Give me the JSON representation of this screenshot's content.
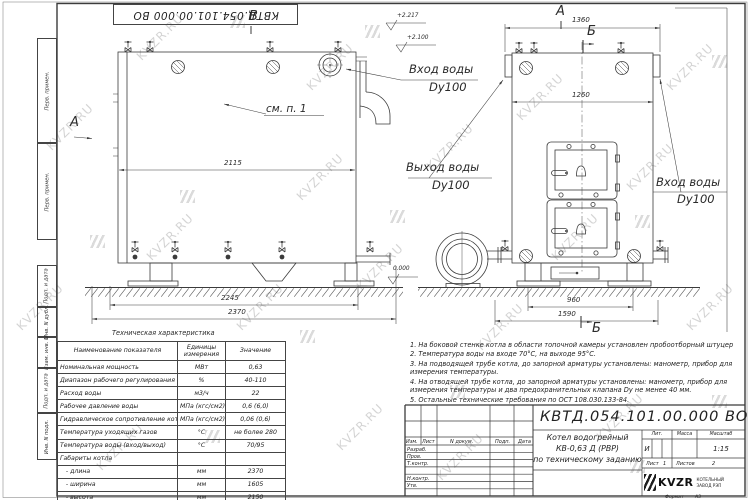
{
  "colors": {
    "line": "#3b3b3b",
    "watermark": "#c3c3c3",
    "paper": "#ffffff"
  },
  "watermark": {
    "text": "KVZR.RU"
  },
  "frame": {
    "top_stamp": "КВТД.054.101.00.000 ВО",
    "margin_boxes": [
      "Перв. примен.",
      "Перв. примен.",
      "Подп. и дата",
      "Инв. N дубл.",
      "Взам. инв. N",
      "Подп. и дата",
      "Инв. N подл."
    ],
    "format_label": "Формат",
    "format_value": "А3"
  },
  "annotations": {
    "view_b": "В",
    "view_a_side": "А",
    "view_a_front": "А",
    "section_b_top": "Б",
    "section_b_bottom": "Б",
    "see_note": "см. п. 1",
    "elev_1": "+2.217",
    "elev_2": "+2.100",
    "elev_zero": "0.000",
    "inlet_top": {
      "l1": "Вход воды",
      "l2": "Dy100"
    },
    "outlet_mid": {
      "l1": "Выход воды",
      "l2": "Dy100"
    },
    "inlet_right": {
      "l1": "Вход воды",
      "l2": "Dy100"
    }
  },
  "dimensions": {
    "side_top": "2115",
    "side_base": "2245",
    "side_full": "2370",
    "front_top": "1360",
    "front_inner": "1260",
    "front_legs": "960",
    "front_base": "1590"
  },
  "spec_table": {
    "title": "Техническая характеристика",
    "headers": [
      "Наименование показателя",
      "Единицы измерения",
      "Значение"
    ],
    "rows": [
      {
        "name": "Номинальная мощность",
        "unit": "МВт",
        "value": "0,63"
      },
      {
        "name": "Диапазон рабочего регулирования",
        "unit": "%",
        "value": "40-110"
      },
      {
        "name": "Расход воды",
        "unit": "м3/ч",
        "value": "22"
      },
      {
        "name": "Рабочее давление воды",
        "unit": "МПа (кгс/см2)",
        "value": "0,6 (6,0)"
      },
      {
        "name": "Гидравлическое сопротивление котла",
        "unit": "МПа (кгс/см2)",
        "value": "0,06 (0,6)"
      },
      {
        "name": "Температура уходящих газов",
        "unit": "°С",
        "value": "не более 280"
      },
      {
        "name": "Температура воды (вход/выход)",
        "unit": "°С",
        "value": "70/95"
      },
      {
        "name": "Габариты котла",
        "unit": "",
        "value": ""
      },
      {
        "name": "   - длина",
        "unit": "мм",
        "value": "2370"
      },
      {
        "name": "   - ширина",
        "unit": "мм",
        "value": "1605"
      },
      {
        "name": "   - высота",
        "unit": "мм",
        "value": "2150"
      }
    ]
  },
  "notes": [
    "1. На боковой стенке котла в области топочной камеры установлен пробоотборный штуцер",
    "2. Температура воды на входе 70°С, на выходе 95°С.",
    "3. На подводящей трубе котла, до запорной арматуры установлены: манометр, прибор для измерения температуры.",
    "4. На отводящей трубе котла, до запорной арматуры установлены: манометр, прибор для измерения температуры и два предохранительных клапана Dу не менее 40 мм.",
    "5. Остальные технические требования по ОСТ 108.030.133-84."
  ],
  "title_block": {
    "designation": "КВТД.054.101.00.000 ВО",
    "rev_headers": [
      "Изм.",
      "Лист",
      "N докум.",
      "Подп.",
      "Дата"
    ],
    "row_labels": [
      "Разраб.",
      "Пров.",
      "Т.контр.",
      "Н.контр.",
      "Утв."
    ],
    "title_lines": [
      "Котел водогрейный",
      "КВ-0,63 Д (РВР)",
      "по техническому заданию"
    ],
    "lit_label": "Лит.",
    "lit_value": "И",
    "mass_label": "Масса",
    "scale_label": "Масштаб",
    "scale_value": "1:15",
    "sheet_label": "Лист",
    "sheet_value": "1",
    "sheets_label": "Листов",
    "sheets_value": "2",
    "company": {
      "logo_text": "KVZR",
      "name_l1": "КОТЕЛЬНЫЙ",
      "name_l2": "ЗАВОД РЭП"
    }
  }
}
